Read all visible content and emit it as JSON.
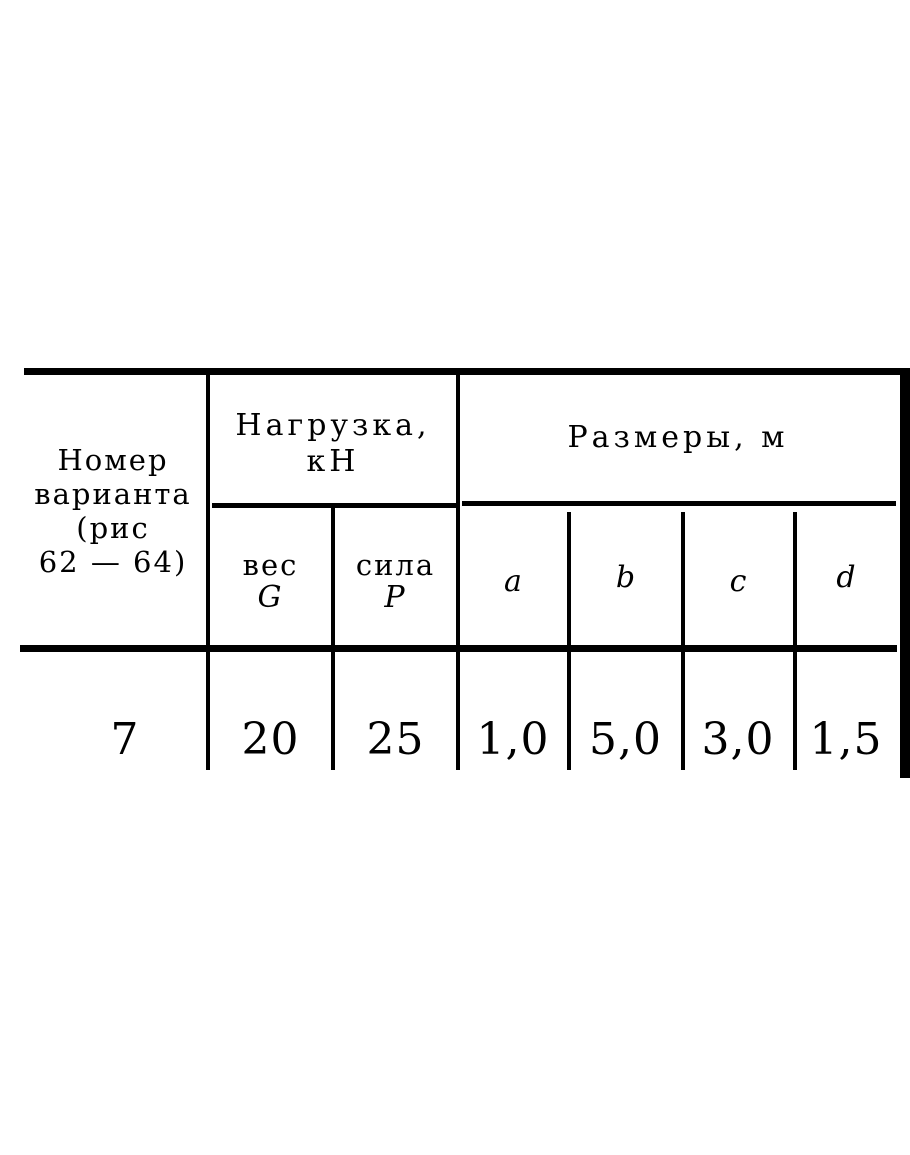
{
  "page": {
    "background": "#ffffff",
    "ink": "#0e0e0e"
  },
  "table": {
    "variant_header": {
      "line1": "Номер",
      "line2": "варианта",
      "line3": "(рис",
      "line4": "62 — 64)"
    },
    "load_group": {
      "title_line1": "Нагрузка,",
      "title_line2": "кН",
      "weight_label": "вес",
      "weight_symbol": "G",
      "force_label": "сила",
      "force_symbol": "Р"
    },
    "dimensions_group": {
      "title": "Размеры, м",
      "columns": [
        "a",
        "b",
        "c",
        "d"
      ]
    },
    "data_row": {
      "variant": "7",
      "weight_g": "20",
      "force_p": "25",
      "a": "1,0",
      "b": "5,0",
      "c": "3,0",
      "d": "1,5"
    }
  }
}
